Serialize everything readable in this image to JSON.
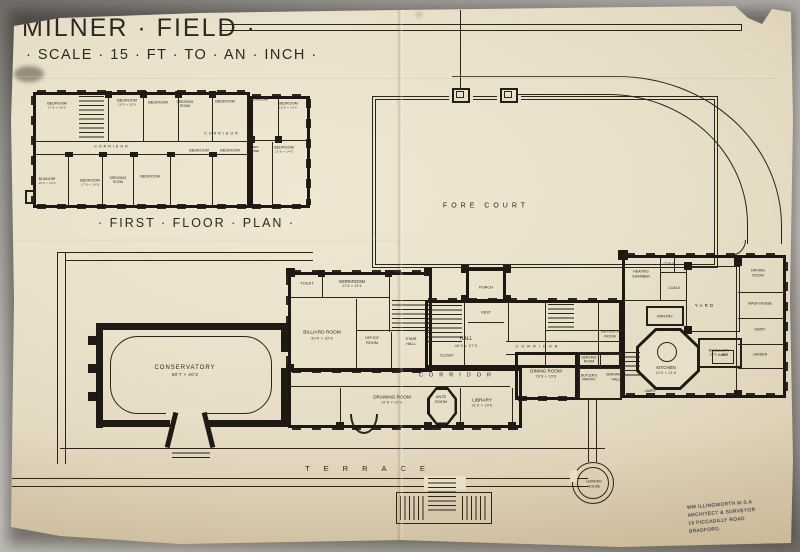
{
  "artwork": {
    "title": "MILNER · FIELD ·",
    "scale_note": "· SCALE · 15 · FT · TO · AN · INCH ·",
    "first_floor_caption": "· FIRST · FLOOR · PLAN ·",
    "stamp_lines": [
      "WM ILLINGWORTH M.S.A",
      "ARCHITECT & SURVEYOR",
      "15 PICCADILLY ROAD",
      "BRADFORD."
    ]
  },
  "colors": {
    "paper": "#e8dfc9",
    "ink": "#2b251d",
    "backdrop": "#b3b0aa"
  },
  "plan_labels": {
    "site": [
      {
        "text": "FORE  COURT",
        "x": 486,
        "y": 206,
        "fs": 7,
        "ls": 4,
        "name": "label-fore-court"
      },
      {
        "text": "TERRACE",
        "x": 372,
        "y": 469,
        "fs": 7.5,
        "ls": 14,
        "name": "label-terrace"
      },
      {
        "text": "GARDEN",
        "sub": "HOUSE",
        "x": 594,
        "y": 484,
        "fs": 3.6,
        "name": "label-garden-house"
      }
    ],
    "ground_floor": [
      {
        "text": "CONSERVATORY",
        "dims": "80'7 × 40'2",
        "x": 185,
        "y": 372,
        "fs": 6,
        "ls": 1,
        "name": "label-conservatory"
      },
      {
        "text": "TOILET",
        "x": 307,
        "y": 284,
        "fs": 3.8
      },
      {
        "text": "WORKROOM",
        "dims": "21'6 × 15'6",
        "x": 352,
        "y": 284,
        "fs": 4.2
      },
      {
        "text": "BILLIARD ROOM",
        "dims": "30'0 × 22'6",
        "x": 322,
        "y": 336,
        "fs": 4.8,
        "name": "label-billiard-room"
      },
      {
        "text": "OFFICE",
        "sub": "ROOM",
        "x": 372,
        "y": 341,
        "fs": 3.8
      },
      {
        "text": "STAIR",
        "sub": "HALL",
        "x": 411,
        "y": 342,
        "fs": 3.8
      },
      {
        "text": "PORCH",
        "x": 486,
        "y": 288,
        "fs": 3.8
      },
      {
        "text": "VEST",
        "x": 486,
        "y": 313,
        "fs": 3.8
      },
      {
        "text": "CLOSET",
        "x": 447,
        "y": 356,
        "fs": 3.5
      },
      {
        "text": "HALL",
        "dims": "40'0 × 27'0",
        "x": 466,
        "y": 342,
        "fs": 5,
        "name": "label-hall"
      },
      {
        "text": "CORRIDOR",
        "x": 538,
        "y": 347,
        "fs": 3.8,
        "ls": 3
      },
      {
        "text": "CORRIDOR",
        "x": 458,
        "y": 376,
        "fs": 5.5,
        "ls": 6,
        "name": "label-corridor"
      },
      {
        "text": "DRAWING ROOM",
        "dims": "37'6 × 21'6",
        "x": 392,
        "y": 400,
        "fs": 4.6,
        "name": "label-drawing-room"
      },
      {
        "text": "ANTE",
        "sub": "ROOM",
        "x": 441,
        "y": 400,
        "fs": 3.8
      },
      {
        "text": "LIBRARY",
        "dims": "31'6 × 19'6",
        "x": 482,
        "y": 403,
        "fs": 4.6,
        "name": "label-library"
      },
      {
        "text": "DINING ROOM",
        "dims": "29'6 × 19'6",
        "x": 546,
        "y": 374,
        "fs": 4.6,
        "name": "label-dining-room"
      },
      {
        "text": "SERVING",
        "sub": "ROOM",
        "x": 589,
        "y": 360,
        "fs": 3.4
      },
      {
        "text": "BUTLER'S",
        "sub": "PANTRY",
        "x": 589,
        "y": 378,
        "fs": 3.4
      },
      {
        "text": "BUTLER'S",
        "sub": "ROOM",
        "x": 610,
        "y": 334,
        "fs": 3.6
      },
      {
        "text": "SERVANTS'",
        "sub": "HALL",
        "x": 616,
        "y": 377,
        "fs": 3.6
      },
      {
        "text": "PANTRY",
        "x": 665,
        "y": 316,
        "fs": 4
      },
      {
        "text": "KITCHEN",
        "dims": "21'6 × 21'6",
        "x": 666,
        "y": 370,
        "fs": 4.4,
        "name": "label-kitchen"
      },
      {
        "text": "SCULLERY",
        "dims": "18'6 × 16'6",
        "x": 719,
        "y": 352,
        "fs": 4
      },
      {
        "text": "YARD",
        "x": 705,
        "y": 306,
        "fs": 4.5,
        "ls": 2,
        "name": "label-yard"
      },
      {
        "text": "HEATING",
        "sub": "CHAMBER",
        "x": 641,
        "y": 274,
        "fs": 3.6
      },
      {
        "text": "COALS",
        "x": 669,
        "y": 264,
        "fs": 3.2
      },
      {
        "text": "COALS",
        "x": 674,
        "y": 288,
        "fs": 3.4
      },
      {
        "text": "DRYING",
        "sub": "ROOM",
        "x": 758,
        "y": 273,
        "fs": 3.6
      },
      {
        "text": "WASH HOUSE",
        "x": 760,
        "y": 304,
        "fs": 3.5
      },
      {
        "text": "DAIRY",
        "x": 760,
        "y": 330,
        "fs": 3.6
      },
      {
        "text": "LARDER",
        "x": 760,
        "y": 355,
        "fs": 3.6
      },
      {
        "text": "LOBBY",
        "x": 723,
        "y": 356,
        "fs": 3
      },
      {
        "text": "LAMPS",
        "x": 650,
        "y": 391,
        "fs": 3.2
      }
    ],
    "first_floor": [
      {
        "text": "BEDROOM",
        "dims": "17'6 × 16'0",
        "x": 57,
        "y": 106,
        "fs": 3.8
      },
      {
        "text": "BEDROOM",
        "dims": "16'0 × 15'0",
        "x": 127,
        "y": 103,
        "fs": 3.8
      },
      {
        "text": "BEDROOM",
        "x": 158,
        "y": 103,
        "fs": 3.8
      },
      {
        "text": "DRESSING",
        "sub": "ROOM",
        "x": 185,
        "y": 104,
        "fs": 3.2
      },
      {
        "text": "BEDROOM",
        "x": 225,
        "y": 102,
        "fs": 3.8
      },
      {
        "text": "BEDROOM",
        "x": 258,
        "y": 100,
        "fs": 3.8
      },
      {
        "text": "BEDROOM",
        "dims": "16'6 × 14'0",
        "x": 288,
        "y": 106,
        "fs": 3.8
      },
      {
        "text": "CORRIDOR",
        "x": 112,
        "y": 147,
        "fs": 3.6,
        "ls": 2
      },
      {
        "text": "CORRIDOR",
        "x": 222,
        "y": 134,
        "fs": 3.6,
        "ls": 2
      },
      {
        "text": "BEDROOM",
        "x": 199,
        "y": 151,
        "fs": 3.8
      },
      {
        "text": "BEDROOM",
        "x": 230,
        "y": 151,
        "fs": 3.8
      },
      {
        "text": "LINEN",
        "sub": "STORE",
        "x": 254,
        "y": 150,
        "fs": 3
      },
      {
        "text": "BEDROOM",
        "dims": "15'6 × 14'6",
        "x": 284,
        "y": 150,
        "fs": 3.8
      },
      {
        "text": "BOUDOIR",
        "dims": "15'0 × 13'0",
        "x": 47,
        "y": 181,
        "fs": 3.6
      },
      {
        "text": "BEDROOM",
        "dims": "17'6 × 14'6",
        "x": 90,
        "y": 183,
        "fs": 3.8
      },
      {
        "text": "DRESSING",
        "sub": "ROOM",
        "x": 118,
        "y": 180,
        "fs": 3.2
      },
      {
        "text": "BEDROOM",
        "x": 150,
        "y": 177,
        "fs": 3.8
      }
    ]
  }
}
